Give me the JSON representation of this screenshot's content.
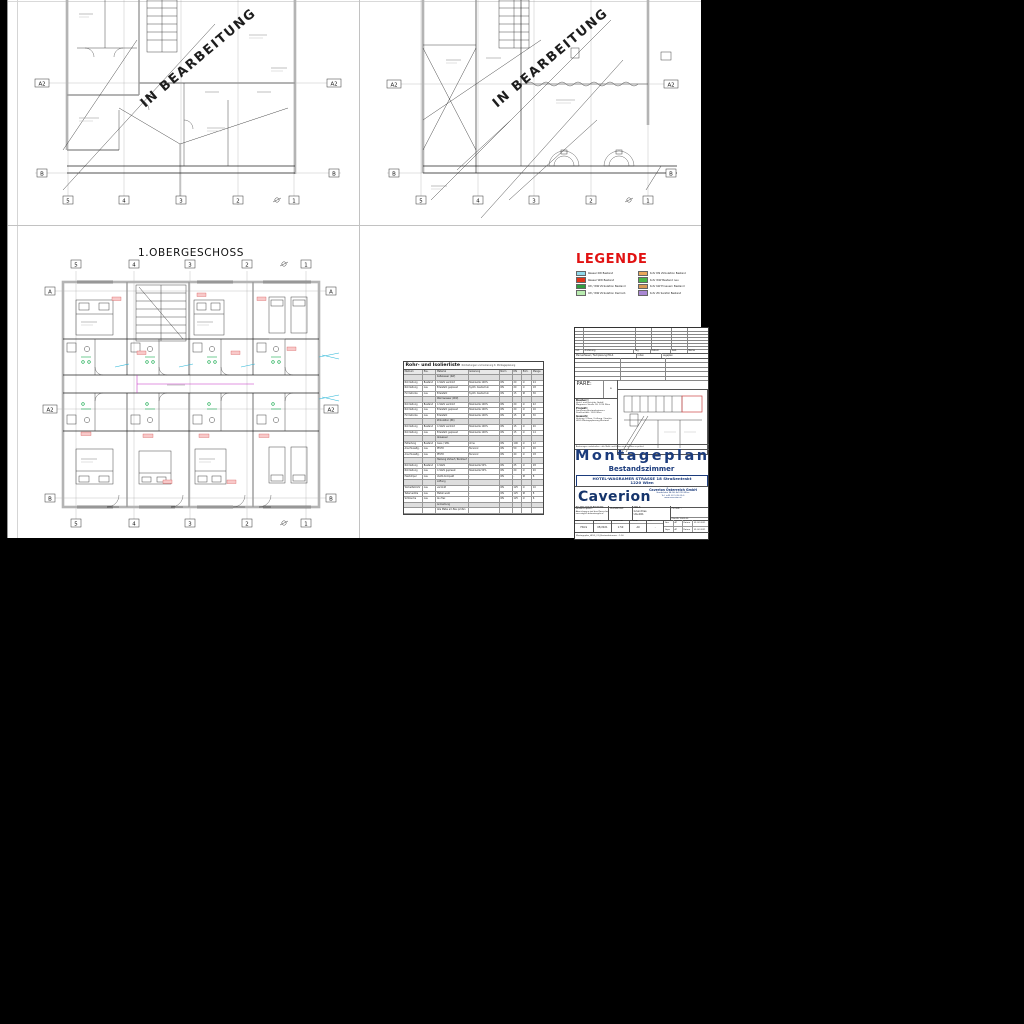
{
  "viewer": {
    "background": "#000000",
    "sheet_bg": "#ffffff"
  },
  "watermark": {
    "text": "IN BEARBEITUNG"
  },
  "plans": {
    "top_left": {
      "rows": [
        "A2",
        "B"
      ],
      "cols": [
        "5",
        "4",
        "3",
        "2",
        "1"
      ]
    },
    "top_right": {
      "rows": [
        "A2",
        "B"
      ],
      "cols": [
        "5",
        "4",
        "3",
        "2",
        "1"
      ]
    },
    "first_floor": {
      "title": "1.OBERGESCHOSS",
      "rows": [
        "A",
        "A2",
        "B"
      ],
      "cols": [
        "5",
        "4",
        "3",
        "2",
        "1"
      ]
    }
  },
  "legend": {
    "title": "LEGENDE",
    "items": [
      {
        "color": "#8fd8ea",
        "label": "Wasser KW Bestand"
      },
      {
        "color": "#e23318",
        "label": "Wasser WW Bestand"
      },
      {
        "color": "#2f9e3f",
        "label": "KW / WW Zirkulation Bestand"
      },
      {
        "color": "#b9ecb0",
        "label": "KW / WW Zirkulation Demont."
      },
      {
        "color": "#e9a85c",
        "label": "Rohr DN Zirkulation Bestand"
      },
      {
        "color": "#49b649",
        "label": "Rohr WW Bestand neu"
      },
      {
        "color": "#d99a56",
        "label": "Rohr KW Erneuern Bestand"
      },
      {
        "color": "#a987d3",
        "label": "Rohr ZK Sanitär Bestand"
      }
    ]
  },
  "pipe_table": {
    "title": "Rohr- und Isolierliste",
    "subtitle": "Rohrleitungen und Isolierung lt. Montageplanung",
    "rows": [
      {
        "bg": "#e8e8e8",
        "cells": [
          "Medium",
          "Pos.",
          "Material",
          "Isolierung",
          "Norm",
          "DN",
          "Einh.",
          "Menge"
        ]
      },
      {
        "bg": "#dedede",
        "cells": [
          "",
          "",
          "Kaltwasser (KW)",
          "",
          "",
          "",
          "",
          ""
        ]
      },
      {
        "bg": "#ffffff",
        "cells": [
          "Rohrleitung",
          "Bestand",
          "C-Stahl verzinkt",
          "Steinwolle 100%",
          "ÖN",
          "20",
          "m",
          "24"
        ]
      },
      {
        "bg": "#ffffff",
        "cells": [
          "Rohrleitung",
          "neu",
          "Edelstahl gepresst",
          "Synth. Kautschuk",
          "ÖN",
          "20",
          "m",
          "18"
        ]
      },
      {
        "bg": "#ffffff",
        "cells": [
          "Formstücke",
          "neu",
          "Edelstahl",
          "Synth. Kautschuk",
          "ÖN",
          "15",
          "St",
          "36"
        ]
      },
      {
        "bg": "#dedede",
        "cells": [
          "",
          "",
          "Warmwasser (WW)",
          "",
          "",
          "",
          "",
          ""
        ]
      },
      {
        "bg": "#ffffff",
        "cells": [
          "Rohrleitung",
          "Bestand",
          "C-Stahl verzinkt",
          "Steinwolle 100%",
          "ÖN",
          "20",
          "m",
          "22"
        ]
      },
      {
        "bg": "#ffffff",
        "cells": [
          "Rohrleitung",
          "neu",
          "Edelstahl gepresst",
          "Steinwolle 100%",
          "ÖN",
          "20",
          "m",
          "16"
        ]
      },
      {
        "bg": "#ffffff",
        "cells": [
          "Formstücke",
          "neu",
          "Edelstahl",
          "Steinwolle 100%",
          "ÖN",
          "15",
          "St",
          "30"
        ]
      },
      {
        "bg": "#dedede",
        "cells": [
          "",
          "",
          "Zirkulation (ZK)",
          "",
          "",
          "",
          "",
          ""
        ]
      },
      {
        "bg": "#ffffff",
        "cells": [
          "Rohrleitung",
          "Bestand",
          "C-Stahl verzinkt",
          "Steinwolle 100%",
          "ÖN",
          "15",
          "m",
          "20"
        ]
      },
      {
        "bg": "#ffffff",
        "cells": [
          "Rohrleitung",
          "neu",
          "Edelstahl gepresst",
          "Steinwolle 100%",
          "ÖN",
          "15",
          "m",
          "14"
        ]
      },
      {
        "bg": "#dedede",
        "cells": [
          "",
          "",
          "Abwasser",
          "",
          "",
          "",
          "",
          ""
        ]
      },
      {
        "bg": "#ffffff",
        "cells": [
          "Fallleitung",
          "Bestand",
          "Guss / SML",
          "ohne",
          "ÖN",
          "100",
          "m",
          "12"
        ]
      },
      {
        "bg": "#ffffff",
        "cells": [
          "Anschlussltg.",
          "neu",
          "PE-HD",
          "Tecsonic",
          "ÖN",
          "50",
          "m",
          "26"
        ]
      },
      {
        "bg": "#ffffff",
        "cells": [
          "Anschlussltg.",
          "neu",
          "PE-HD",
          "Tecsonic",
          "ÖN",
          "40",
          "m",
          "18"
        ]
      },
      {
        "bg": "#dedede",
        "cells": [
          "",
          "",
          "Heizung Vorlauf / Rücklauf",
          "",
          "",
          "",
          "",
          ""
        ]
      },
      {
        "bg": "#ffffff",
        "cells": [
          "Rohrleitung",
          "Bestand",
          "C-Stahl",
          "Steinwolle 50%",
          "ÖN",
          "25",
          "m",
          "28"
        ]
      },
      {
        "bg": "#ffffff",
        "cells": [
          "Rohrleitung",
          "neu",
          "C-Stahl gepresst",
          "Steinwolle 50%",
          "ÖN",
          "20",
          "m",
          "20"
        ]
      },
      {
        "bg": "#ffffff",
        "cells": [
          "Heizkörper",
          "neu",
          "Ventil-Kompakt",
          "-",
          "ÖN",
          "-",
          "St",
          "8"
        ]
      },
      {
        "bg": "#dedede",
        "cells": [
          "",
          "",
          "Lüftung",
          "",
          "",
          "",
          "",
          ""
        ]
      },
      {
        "bg": "#ffffff",
        "cells": [
          "Wickelfalzrohr",
          "neu",
          "verzinkt",
          "-",
          "ÖN",
          "125",
          "m",
          "10"
        ]
      },
      {
        "bg": "#ffffff",
        "cells": [
          "Tellerventile",
          "neu",
          "Metall weiß",
          "-",
          "ÖN",
          "125",
          "St",
          "8"
        ]
      },
      {
        "bg": "#ffffff",
        "cells": [
          "Schläuche",
          "neu",
          "Alu flex",
          "-",
          "ÖN",
          "125",
          "m",
          "6"
        ]
      },
      {
        "bg": "#dedede",
        "cells": [
          "",
          "",
          "Anmerkung",
          "",
          "",
          "",
          "",
          ""
        ]
      },
      {
        "bg": "#ffffff",
        "cells": [
          "",
          "",
          "Alle Maße am Bau prüfen",
          "",
          "",
          "",
          "",
          ""
        ]
      }
    ]
  },
  "title_block": {
    "rev_headers": [
      "Ind.",
      "Änderung",
      "Tag",
      "Datum",
      "Gez.",
      "Name"
    ],
    "strip_labels": [
      "Planverfasser / Fachplanung HKLS",
      "Index",
      "Lageplan"
    ],
    "stamp_label": "PARE:",
    "stamp_note": "a",
    "sections": [
      {
        "head": "Bauherr:",
        "line1": "Hotel- und Betriebs GmbH",
        "line2": "Wagramer Straße 18, 1220 Wien"
      },
      {
        "head": "Projekt:",
        "line1": "Sanierung Bestandszimmer",
        "line2": "Straßentrakt, 1220 Wien"
      },
      {
        "head": "Gewerk:",
        "line1": "Heizung / Klima / Lüftung / Sanitär",
        "line2": "HKLS Montageplanung Bestand"
      }
    ],
    "micro_strip": "Änderungen vorbehalten - alle Maße und Höhen sind am Bau zu prüfen!",
    "project_title": "Montageplan",
    "project_subtitle": "Bestandszimmer",
    "address_line1": "HOTEL-WAGRAMER STRASSE 18 Straßentrakt",
    "address_line2": "1220 Wien",
    "logo": "Caverion",
    "company_name": "Caverion Österreich GmbH",
    "company_lines": [
      "Handelskai 94-96, A-1220 Wien",
      "Tel. +43 (0) 5 05 05-0",
      "www.caverion.at"
    ],
    "info_lines": [
      "Alle Maße sind vor Ausführung",
      "am Bau zu prüfen!",
      "Abweichungen sind dem Planverfasser",
      "unverzüglich bekanntzugeben!"
    ],
    "planinhalt_label": "PLANINHALT:",
    "content_lines": [
      "HKLS",
      "Grundriss",
      "UG-001"
    ],
    "format_label": "Format:",
    "format_value": "-",
    "format_note": "Plan-Nr. 0000-00",
    "fields_headers": [
      "GEZ.",
      "DATUM",
      "MASSSTAB",
      "FORMAT",
      "IND."
    ],
    "fields_values": [
      "HKLS",
      "05/2021",
      "1:50",
      "A0",
      "-"
    ],
    "sign": {
      "g_label": "Gez.",
      "g_val": "AT",
      "gd_label": "Datum",
      "gd_val": "01.02.2021",
      "p_label": "Gepr.",
      "p_val": "AT",
      "pd_label": "Datum",
      "pd_val": "01.02.2021"
    },
    "footer_strip": "Montageplan_HKLS_OG_Bestandszimmer - 1:50"
  }
}
